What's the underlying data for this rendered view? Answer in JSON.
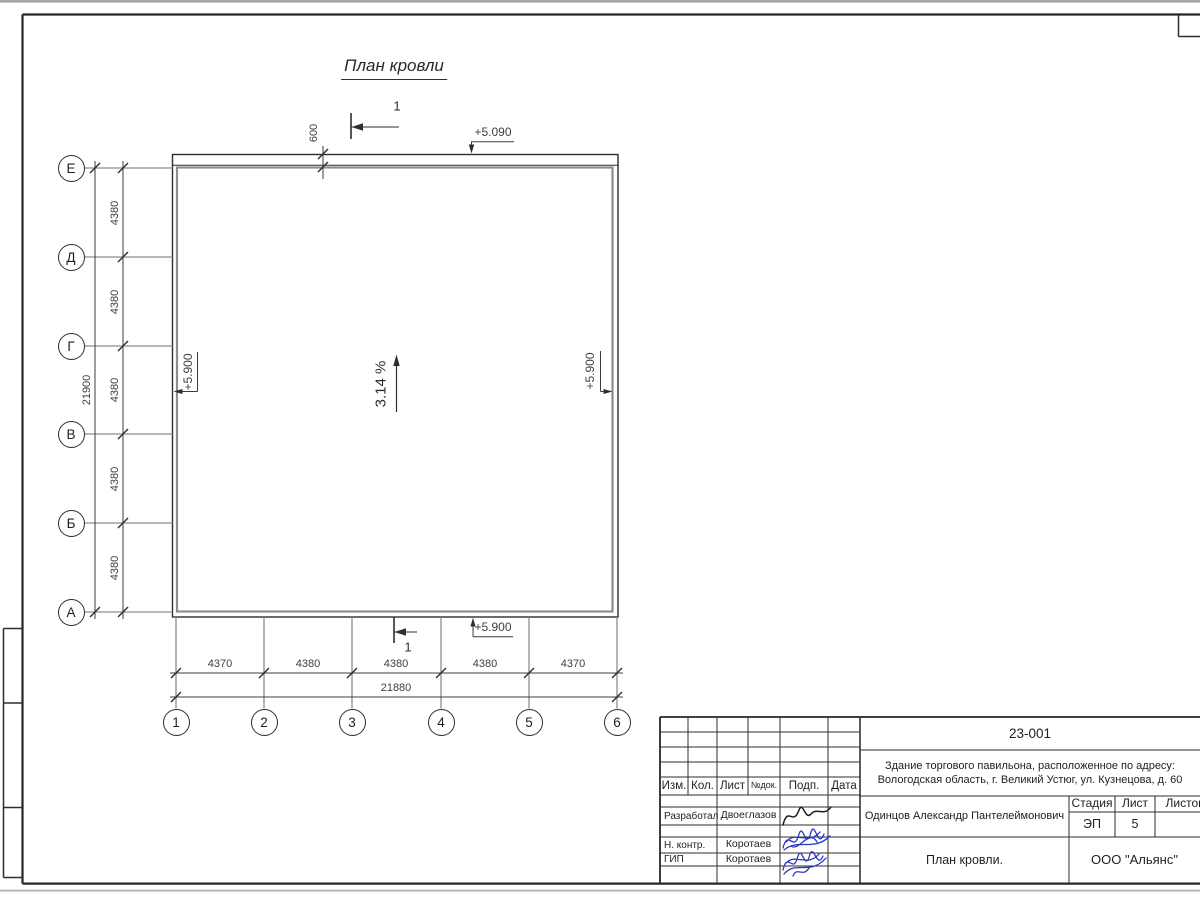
{
  "colors": {
    "line": "#2e2e2e",
    "gray_line": "#8d8d8d",
    "signature_blue": "#2a35c8"
  },
  "plan": {
    "title": "План кровли",
    "slope": "3.14 %",
    "section_number": "1",
    "elevation_top": "+5.090",
    "elevation_left": "+5.900",
    "elevation_right": "+5.900",
    "elevation_bottom": "+5.900",
    "overhang": "600"
  },
  "axes": {
    "rows": [
      {
        "label": "Е"
      },
      {
        "label": "Д"
      },
      {
        "label": "Г"
      },
      {
        "label": "В"
      },
      {
        "label": "Б"
      },
      {
        "label": "А"
      }
    ],
    "cols": [
      {
        "label": "1"
      },
      {
        "label": "2"
      },
      {
        "label": "3"
      },
      {
        "label": "4"
      },
      {
        "label": "5"
      },
      {
        "label": "6"
      }
    ],
    "row_dims": [
      "4380",
      "4380",
      "4380",
      "4380",
      "4380"
    ],
    "row_total": "21900",
    "col_dims": [
      "4370",
      "4380",
      "4380",
      "4380",
      "4370"
    ],
    "col_total": "21880"
  },
  "title_block": {
    "doc_number": "23-001",
    "object_address_line1": "Здание торгового павильона, расположенное по адресу:",
    "object_address_line2": "Вологодская область, г. Великий Устюг, ул. Кузнецова, д. 60",
    "columns": [
      "Изм.",
      "Кол.",
      "Лист",
      "№док.",
      "Подп.",
      "Дата"
    ],
    "rows": [
      {
        "role": "Разработал",
        "name": "Двоеглазов"
      },
      {
        "role": "Н. контр.",
        "name": "Коротаев"
      },
      {
        "role": "ГИП",
        "name": "Коротаев"
      }
    ],
    "approver_name": "Одинцов Александр Пантелеймонович",
    "stage_label": "Стадия",
    "sheet_label": "Лист",
    "sheets_label": "Листов",
    "stage_value": "ЭП",
    "sheet_value": "5",
    "sheets_value": "",
    "sheet_title": "План кровли.",
    "company": "ООО \"Альянс\""
  }
}
